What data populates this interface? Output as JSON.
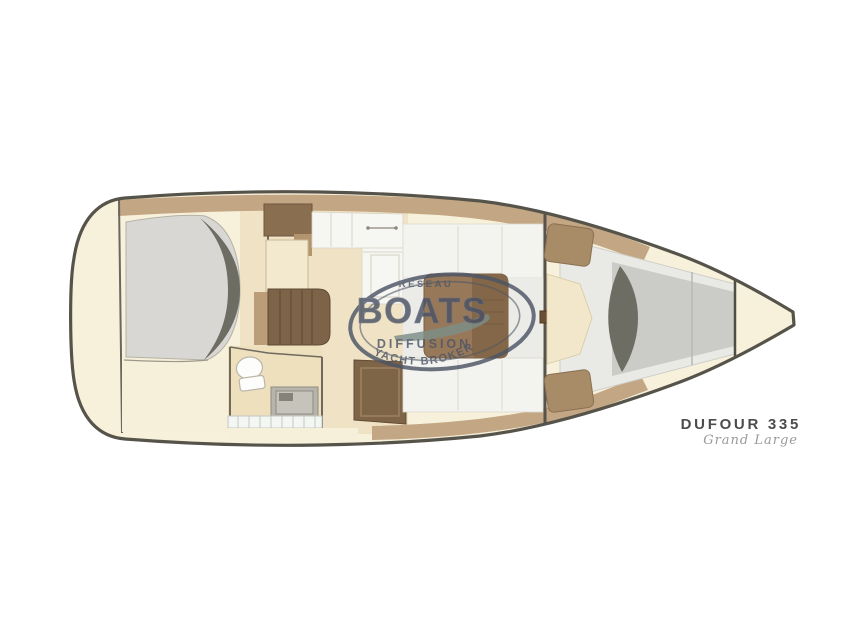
{
  "title": "Sailboat interior deck plan",
  "watermark": {
    "network": "RÉSEAU",
    "brand": "BOATS",
    "line1": "DIFFUSION",
    "line2": "YACHT BROKER"
  },
  "footer": {
    "model": "DUFOUR 335",
    "variant": "Grand Large"
  },
  "palette": {
    "background": "#ffffff",
    "hull_fill": "#f7f1dc",
    "hull_stroke": "#56544a",
    "trim_tan": "#c3a684",
    "cabinet_brown": "#8a6e50",
    "steps_brown": "#7d6347",
    "table_brown": "#97795a",
    "berth_gray": "#d8d7d3",
    "shadow_gray": "#6e6d63",
    "watermark_slate": "#4d5565",
    "swoosh_teal": "#7c8e87",
    "model_text": "#4c4c4c"
  }
}
